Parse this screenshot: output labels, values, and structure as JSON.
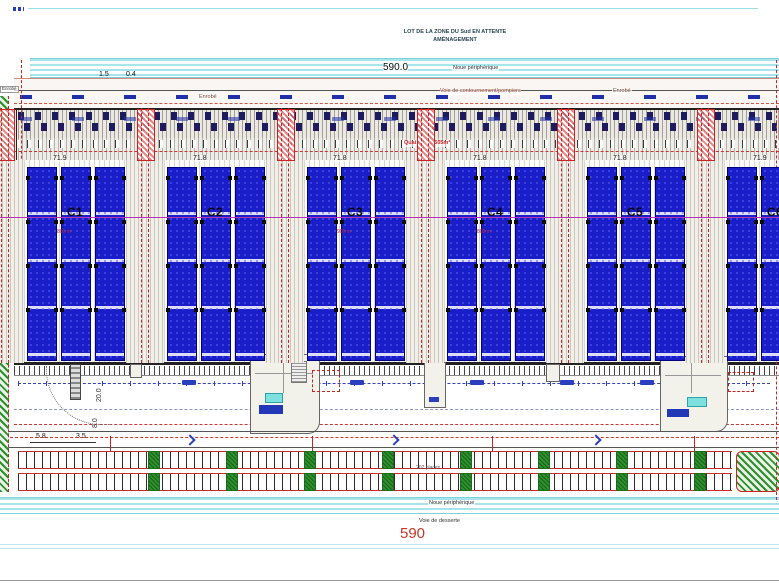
{
  "title": {
    "line1": "LOT DE LA ZONE DU Sud EN ATTENTE",
    "line2": "AMÉNAGEMENT"
  },
  "top_band": {
    "label": "Noue périphérique",
    "dim": "590.0"
  },
  "top_dims": [
    "1.5",
    "0.4",
    "6.0",
    "4.0",
    "6.1",
    "8.5"
  ],
  "road": {
    "label": "Voie de contournement/pompiers",
    "enrobe": "Enrobé"
  },
  "building": {
    "quai_label": "Quai fer - 5.505m²",
    "cells": [
      {
        "name": "C1",
        "dim": "71.9",
        "area": "800 m"
      },
      {
        "name": "C2",
        "dim": "71.8",
        "area": ""
      },
      {
        "name": "C3",
        "dim": "71.8",
        "area": "900 m"
      },
      {
        "name": "C4",
        "dim": "71.8",
        "area": "800 m"
      },
      {
        "name": "C5",
        "dim": "71.8",
        "area": ""
      },
      {
        "name": "C6",
        "dim": "71.9",
        "area": ""
      }
    ]
  },
  "yard": {
    "dim_v1": "38.3",
    "dim_v2": "20.0",
    "dim_v3": "8.0",
    "dim_h1": "5.8",
    "dim_h2": "3.5"
  },
  "parking": {
    "label": "202 places"
  },
  "bottom": {
    "noue": "Noue périphérique",
    "road": "Voie de desserte",
    "dim": "590"
  },
  "colors": {
    "rack_blue": "#1a1ec9",
    "fire_red": "#cc2222",
    "noue_cyan": "#a8e4ec",
    "tree_green": "#2f8f2f",
    "dim_red": "#c0392b",
    "magenta": "#b832b8"
  }
}
